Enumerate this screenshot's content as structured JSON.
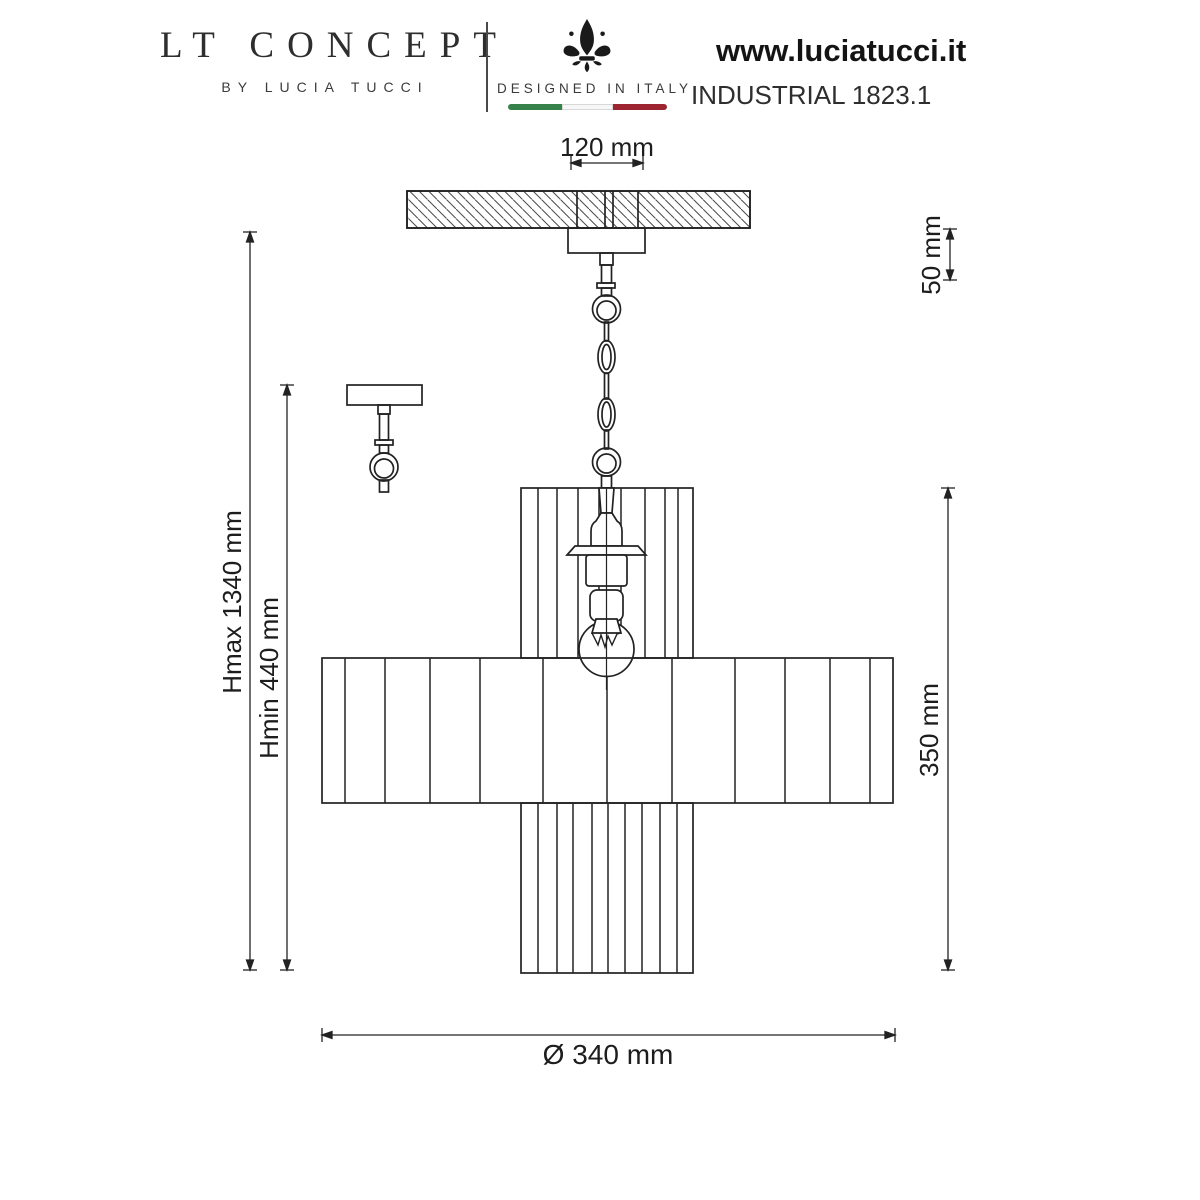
{
  "header": {
    "brand": {
      "title": "LT CONCEPT",
      "subtitle": "BY LUCIA TUCCI"
    },
    "made_in": {
      "label": "DESIGNED IN ITALY",
      "icon": "fleur-de-lis-icon",
      "flag_colors": {
        "green": "#37814a",
        "white": "#f7f7f7",
        "red": "#9c2531"
      }
    },
    "website": "www.luciatucci.it",
    "product": "INDUSTRIAL 1823.1"
  },
  "drawing": {
    "type": "technical-line-drawing",
    "subject": "pendant chandelier with ceiling mount, chain suspension and three-tier ribbed shade",
    "line_color": "#222222",
    "dimensions": {
      "canopy_width": "120 mm",
      "top_offset": "50 mm",
      "height_max": "Hmax 1340 mm",
      "height_min": "Hmin 440 mm",
      "shade_height": "350 mm",
      "diameter": "Ø 340 mm"
    }
  }
}
